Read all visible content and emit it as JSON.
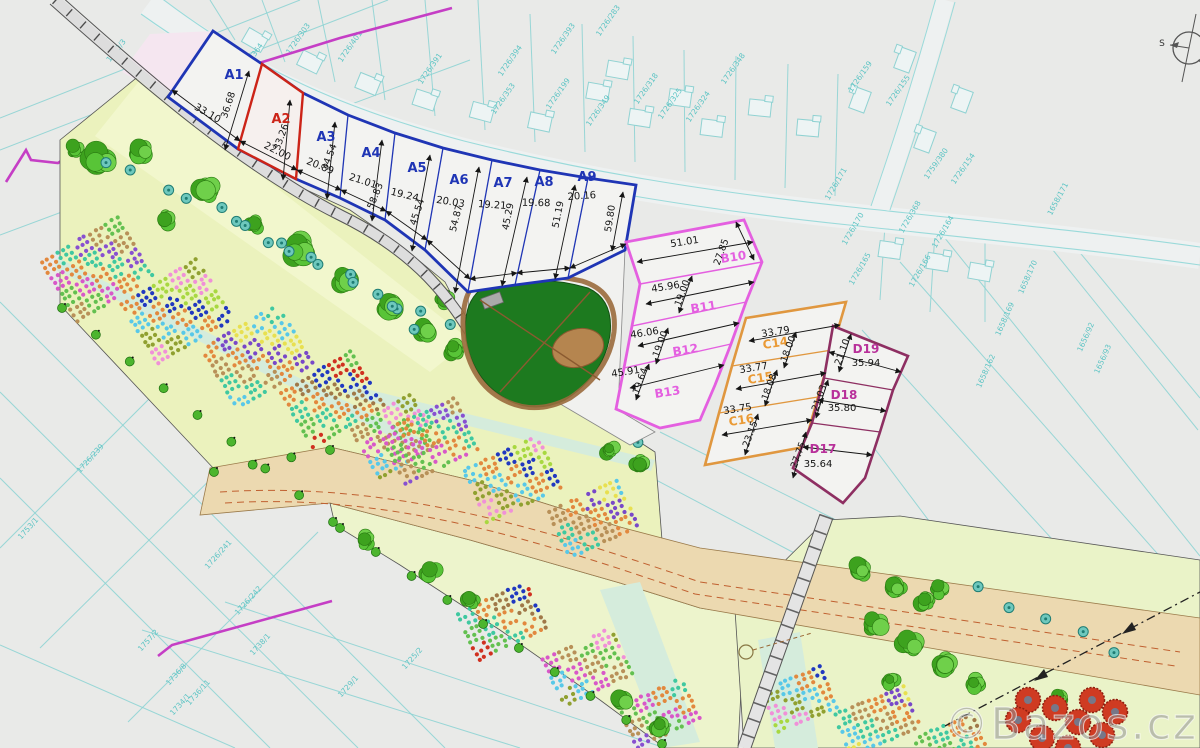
{
  "watermark": {
    "text": "©Bazos.cz"
  },
  "compass": {
    "label": "S"
  },
  "plot_groups": [
    {
      "group": "A",
      "items": [
        {
          "label": "A1",
          "len": "33.10",
          "side": "36.68"
        },
        {
          "label": "A2",
          "len": "22.00",
          "side": "33.26"
        },
        {
          "label": "A3",
          "len": "20.89",
          "side": "34.54"
        },
        {
          "label": "A4",
          "len": "21.01",
          "side": "58.83"
        },
        {
          "label": "A5",
          "len": "19.24",
          "side": "45.54"
        },
        {
          "label": "A6",
          "len": "20.03",
          "side": "54.87"
        },
        {
          "label": "A7",
          "len": "19.21",
          "side": "45.29"
        },
        {
          "label": "A8",
          "len": "19.68",
          "side": "51.19"
        },
        {
          "label": "A9",
          "len": "20.16",
          "side": "59.80"
        }
      ]
    },
    {
      "group": "B",
      "items": [
        {
          "label": "B10",
          "len": "51.01",
          "side": "27.85"
        },
        {
          "label": "B11",
          "len": "45.96",
          "side": "19.00"
        },
        {
          "label": "B12",
          "len": "46.06",
          "side": "19.00"
        },
        {
          "label": "B13",
          "len": "45.91",
          "side": "19.64"
        }
      ]
    },
    {
      "group": "C",
      "items": [
        {
          "label": "C14",
          "len": "33.79",
          "side": "18.00"
        },
        {
          "label": "C15",
          "len": "33.77",
          "side": "18.08"
        },
        {
          "label": "C16",
          "len": "33.75",
          "side": "23.15"
        }
      ]
    },
    {
      "group": "D",
      "items": [
        {
          "label": "D19",
          "len": "35.94",
          "side": "21.10"
        },
        {
          "label": "D18",
          "len": "35.80",
          "side": "21.03"
        },
        {
          "label": "D17",
          "len": "35.64",
          "side": "27.75"
        }
      ]
    }
  ],
  "cadastral_parcels": [
    "1726/364",
    "1726/303",
    "1726/401",
    "1726/391",
    "1726/394",
    "1726/393",
    "1726/283",
    "1726/353",
    "1726/199",
    "1726/349",
    "1726/318",
    "1726/325",
    "1726/324",
    "1726/348",
    "1726/159",
    "1726/155",
    "1726/154",
    "1759/380",
    "1726/171",
    "1726/170",
    "1726/368",
    "1726/164",
    "1726/165",
    "1726/166",
    "1658/171",
    "1658/170",
    "1658/169",
    "1658/162",
    "1656/92",
    "1656/93",
    "1660/3",
    "557/5",
    "1726/239",
    "1753/1",
    "1726/241",
    "1726/242",
    "1757/2",
    "1736/8",
    "1736/11",
    "1734/1",
    "1738/1",
    "1729/1",
    "1725/2",
    "1887/4"
  ],
  "colors": {
    "group_a": "#1f35b5",
    "group_a2": "#cc2418",
    "group_b": "#e45fe0",
    "group_c": "#ea9a35",
    "group_d": "#8e2f62",
    "cadastre": "#5cc4c4"
  }
}
